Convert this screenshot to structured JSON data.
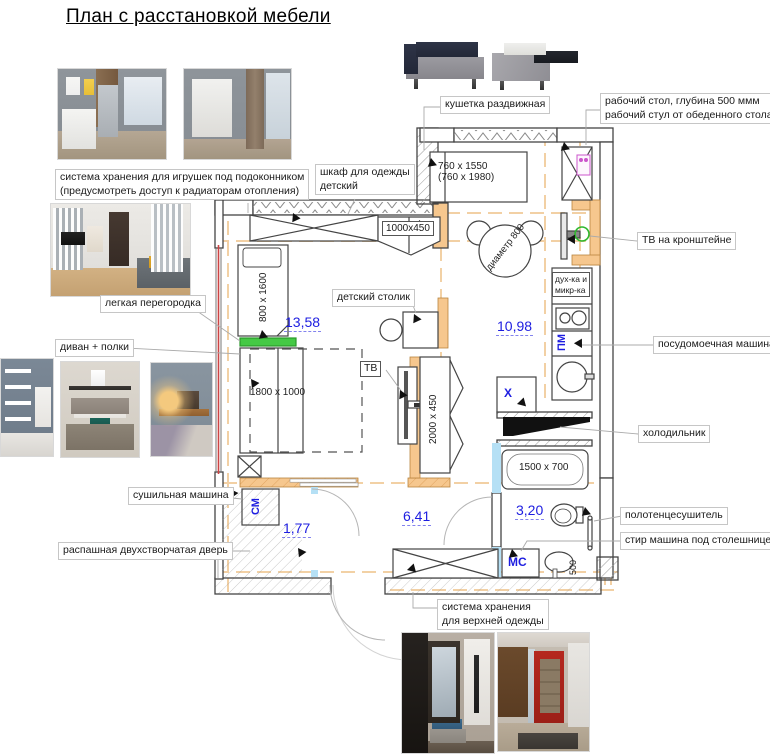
{
  "title": "План с расстановкой мебели",
  "callouts": {
    "daybed": "кушетка раздвижная",
    "work_desk_1": "рабочий стол, глубина 500 ммм",
    "work_desk_2": "рабочий стул от обеденного стола",
    "toy_storage_1": "система хранения для игрушек под подоконником",
    "toy_storage_2": "(предусмотреть доступ к радиаторам отопления)",
    "child_wardrobe_1": "шкаф для одежды",
    "child_wardrobe_2": "детский",
    "tv_bracket": "ТВ на кронштейне",
    "light_partition": "легкая перегородка",
    "sofa_shelves": "диван + полки",
    "child_table": "детский столик",
    "dishwasher": "посудомоечная машина",
    "fridge": "холодильник",
    "dryer": "сушильная машина",
    "towel_rail": "полотенцесушитель",
    "washer_under_counter": "стир машина под столешницей",
    "entrance_door": "распашная двухстворчатая дверь",
    "coat_storage_1": "система хранения",
    "coat_storage_2": "для верхней одежды"
  },
  "dimensions": {
    "daybed_1": "760 x 1550",
    "daybed_2": "(760 x 1980)",
    "hall_unit": "1000x450",
    "child_bed": "800 x 1600",
    "sofa_bed": "1800 x 1000",
    "tv_cabinet": "2000 x 450",
    "bathtub": "1500 x 700",
    "washer_depth": "500",
    "table": "диаметр 800"
  },
  "areas": {
    "child_room": "13,58",
    "kitchen_living": "10,98",
    "closet": "1,77",
    "hallway": "6,41",
    "bathroom": "3,20"
  },
  "marks": {
    "washing_machine": "СМ",
    "dishwasher": "ПМ",
    "washer_bath": "МС",
    "fridge": "Х",
    "tv": "ТВ",
    "oven_1": "дух-ка и",
    "oven_2": "микр-ка"
  },
  "colors": {
    "accent_wall": "#f6c78e",
    "axis_dash": "#f1cc9b",
    "area_text": "#1d1de0",
    "partition_green": "#45c945",
    "door_blue": "#b5e0f5",
    "window_red": "#cc4444",
    "socket_magenta": "#cc55cc",
    "bracket_green": "#2eb82e"
  }
}
